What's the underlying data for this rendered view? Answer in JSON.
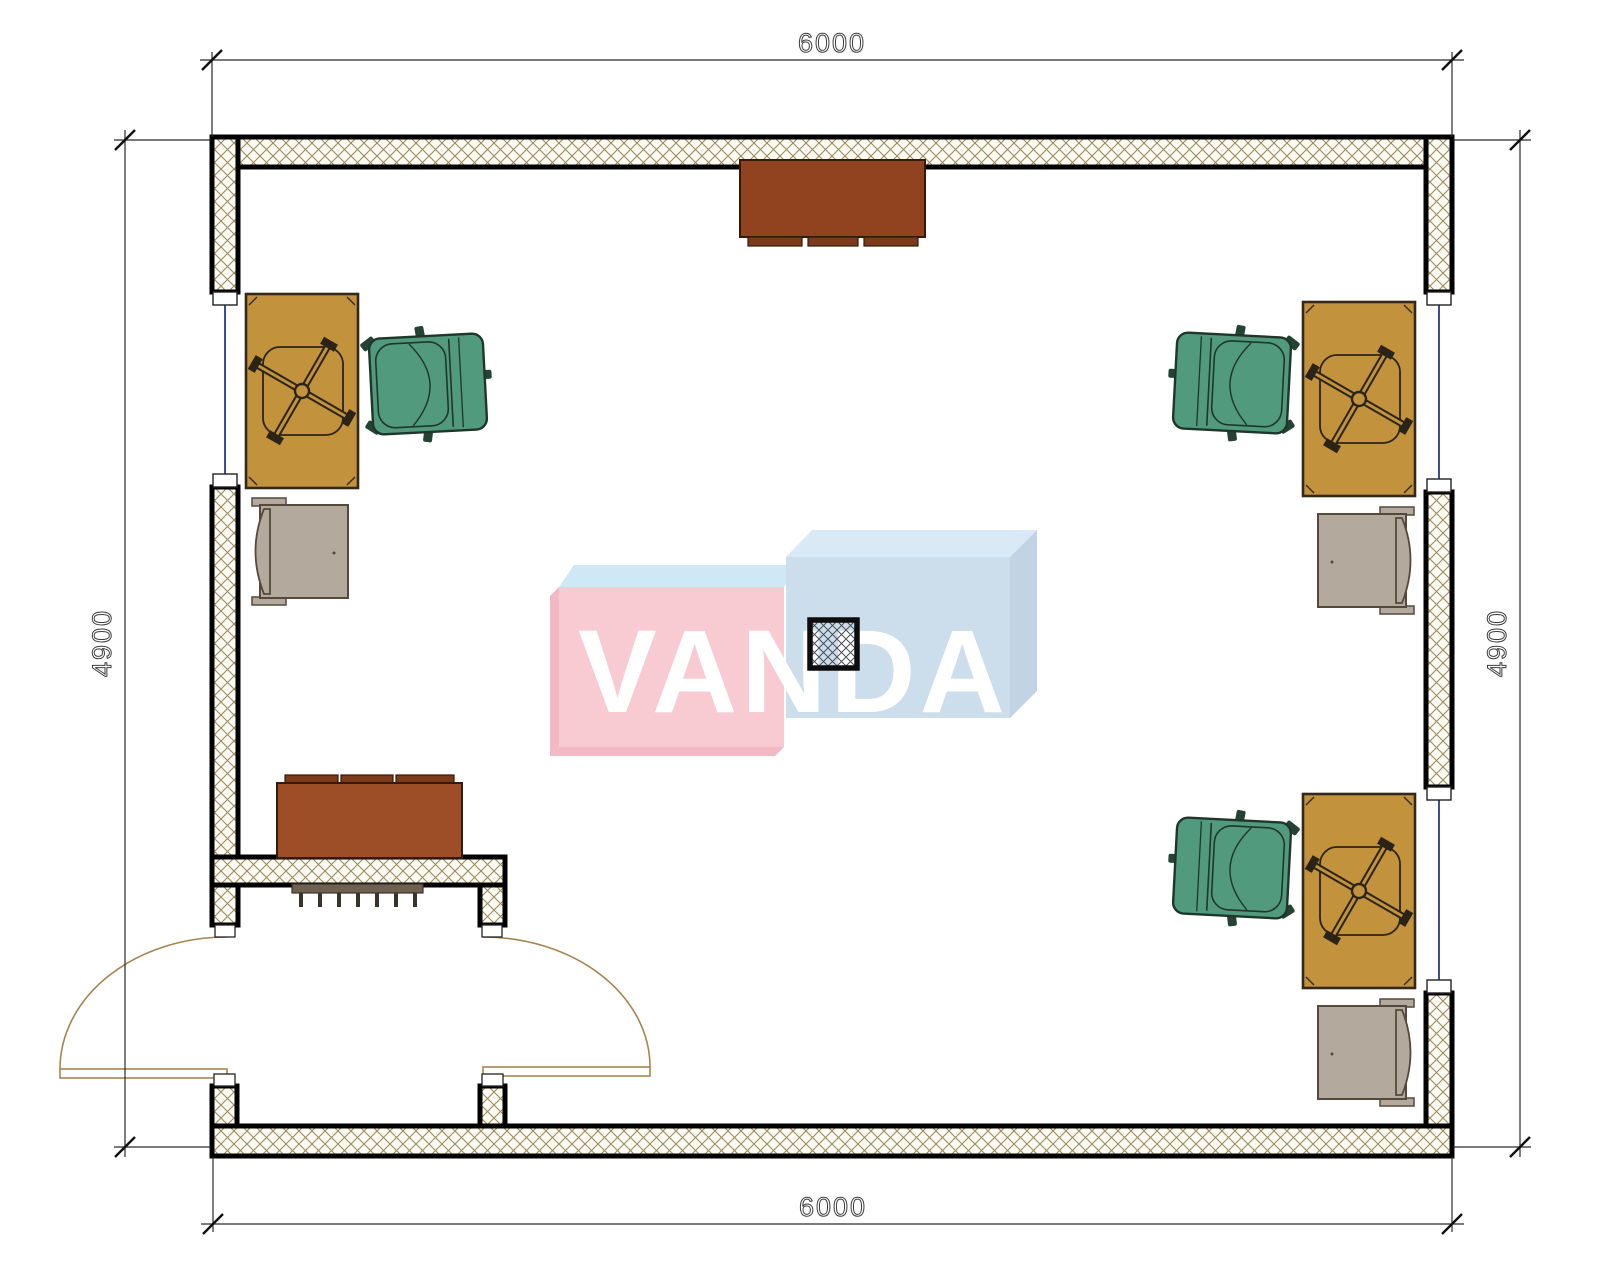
{
  "plan": {
    "type": "office-floor-plan",
    "dimensions": {
      "top": "6000",
      "bottom": "6000",
      "left": "4900",
      "right": "4900"
    },
    "watermark": {
      "text": "VANDA"
    },
    "furniture": [
      "desk-with-task-chair-base-left",
      "desk-with-task-chair-base-right-top",
      "desk-with-task-chair-base-right-bottom",
      "office-armchair-left",
      "office-armchair-right-top",
      "office-armchair-right-bottom",
      "side-chair-left",
      "side-chair-right-top",
      "side-chair-right-bottom",
      "sideboard-top-wall",
      "sideboard-entry",
      "radiator-entry",
      "structural-column",
      "double-entry-door",
      "window-left",
      "window-right-upper",
      "window-right-lower"
    ],
    "colors": {
      "wall_outline": "#000000",
      "wall_hatch": "#9b8c5e",
      "window_glazing": "#3a4e9c",
      "desk": "#c2923c",
      "office_chair": "#529a7e",
      "side_chair": "#b3a99c",
      "wood_dark": "#91431f",
      "door_swing": "#a8834f",
      "watermark_pink": "#f8cbd3",
      "watermark_blue": "#ccddeb",
      "watermark_top": "#d9eaf6"
    }
  }
}
